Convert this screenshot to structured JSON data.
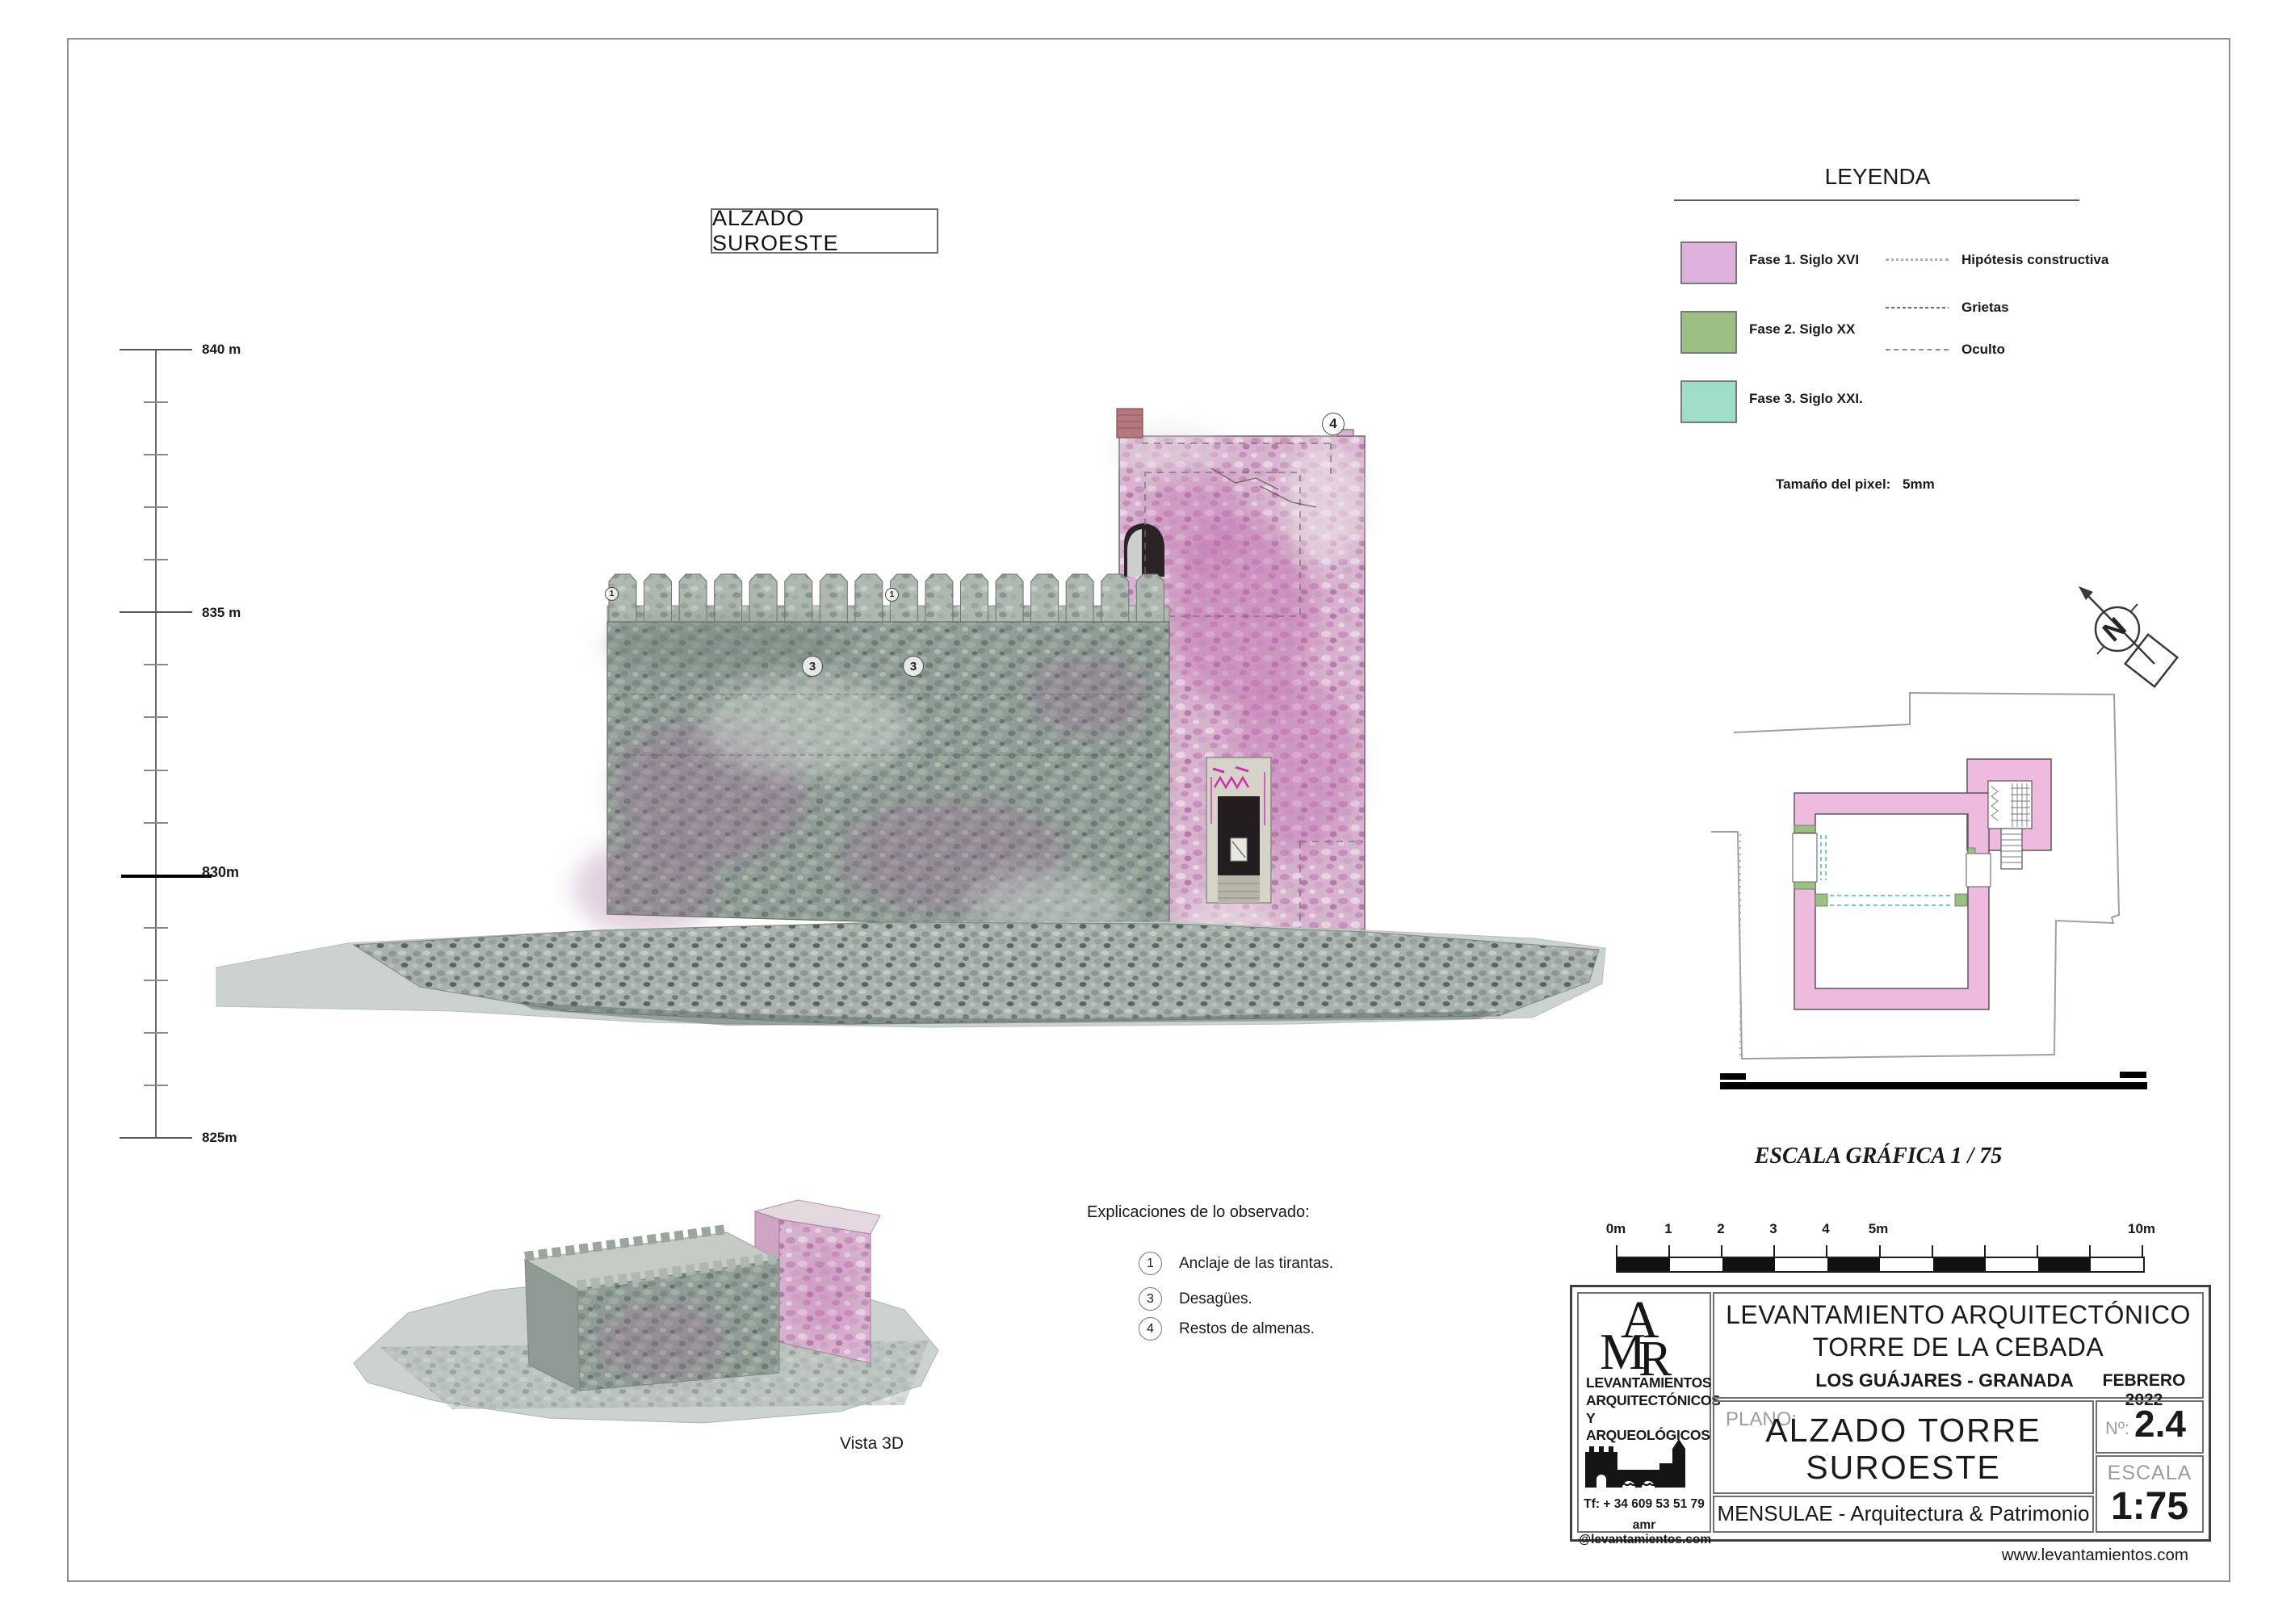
{
  "sheet": {
    "title_box": "ALZADO  SUROESTE",
    "website": "www.levantamientos.com",
    "vista3d_label": "Vista 3D"
  },
  "legend": {
    "title": "LEYENDA",
    "phases": [
      {
        "label": "Fase 1.  Siglo XVI",
        "color": "#deb1dd"
      },
      {
        "label": "Fase 2. Siglo XX",
        "color": "#9cbf84"
      },
      {
        "label": "Fase 3. Siglo XXI.",
        "color": "#9fdcca"
      }
    ],
    "lines": [
      {
        "label": "Hipótesis constructiva"
      },
      {
        "label": "Grietas"
      },
      {
        "label": "Oculto"
      }
    ],
    "pixel_label": "Tamaño del pixel:",
    "pixel_value": "5mm"
  },
  "elevation_scale": {
    "marks": [
      "840 m",
      "835 m",
      "830m",
      "825m"
    ]
  },
  "graphic_scale": {
    "title": "ESCALA GRÁFICA   1 / 75",
    "ticks": [
      "0m",
      "1",
      "2",
      "3",
      "4",
      "5m",
      "10m"
    ]
  },
  "observations": {
    "heading": "Explicaciones de lo observado:",
    "items": [
      {
        "num": "1",
        "text": "Anclaje de las tirantas."
      },
      {
        "num": "3",
        "text": "Desagües."
      },
      {
        "num": "4",
        "text": "Restos de almenas."
      }
    ]
  },
  "markers": {
    "m4": "4",
    "m3a": "3",
    "m3b": "3",
    "m1a": "1",
    "m1b": "1"
  },
  "title_block": {
    "logo": {
      "letters": [
        "A",
        "M",
        "R"
      ],
      "company_lines": [
        "LEVANTAMIENTOS",
        "ARQUITECTÓNICOS",
        "Y ARQUEOLÓGICOS"
      ],
      "phone": "Tf: + 34  609 53 51 79",
      "email": "amr @levantamientos.com"
    },
    "project_line1": "LEVANTAMIENTO ARQUITECTÓNICO",
    "project_line2": "TORRE DE LA CEBADA",
    "location": "LOS GUÁJARES  -  GRANADA",
    "date": "FEBRERO  2022",
    "plano_label": "PLANO:",
    "plano_line1": "ALZADO  TORRE",
    "plano_line2": "SUROESTE",
    "num_label": "Nº:",
    "num_value": "2.4",
    "escala_label": "ESCALA",
    "escala_value": "1:75",
    "studio": "MENSULAE - Arquitectura & Patrimonio"
  }
}
